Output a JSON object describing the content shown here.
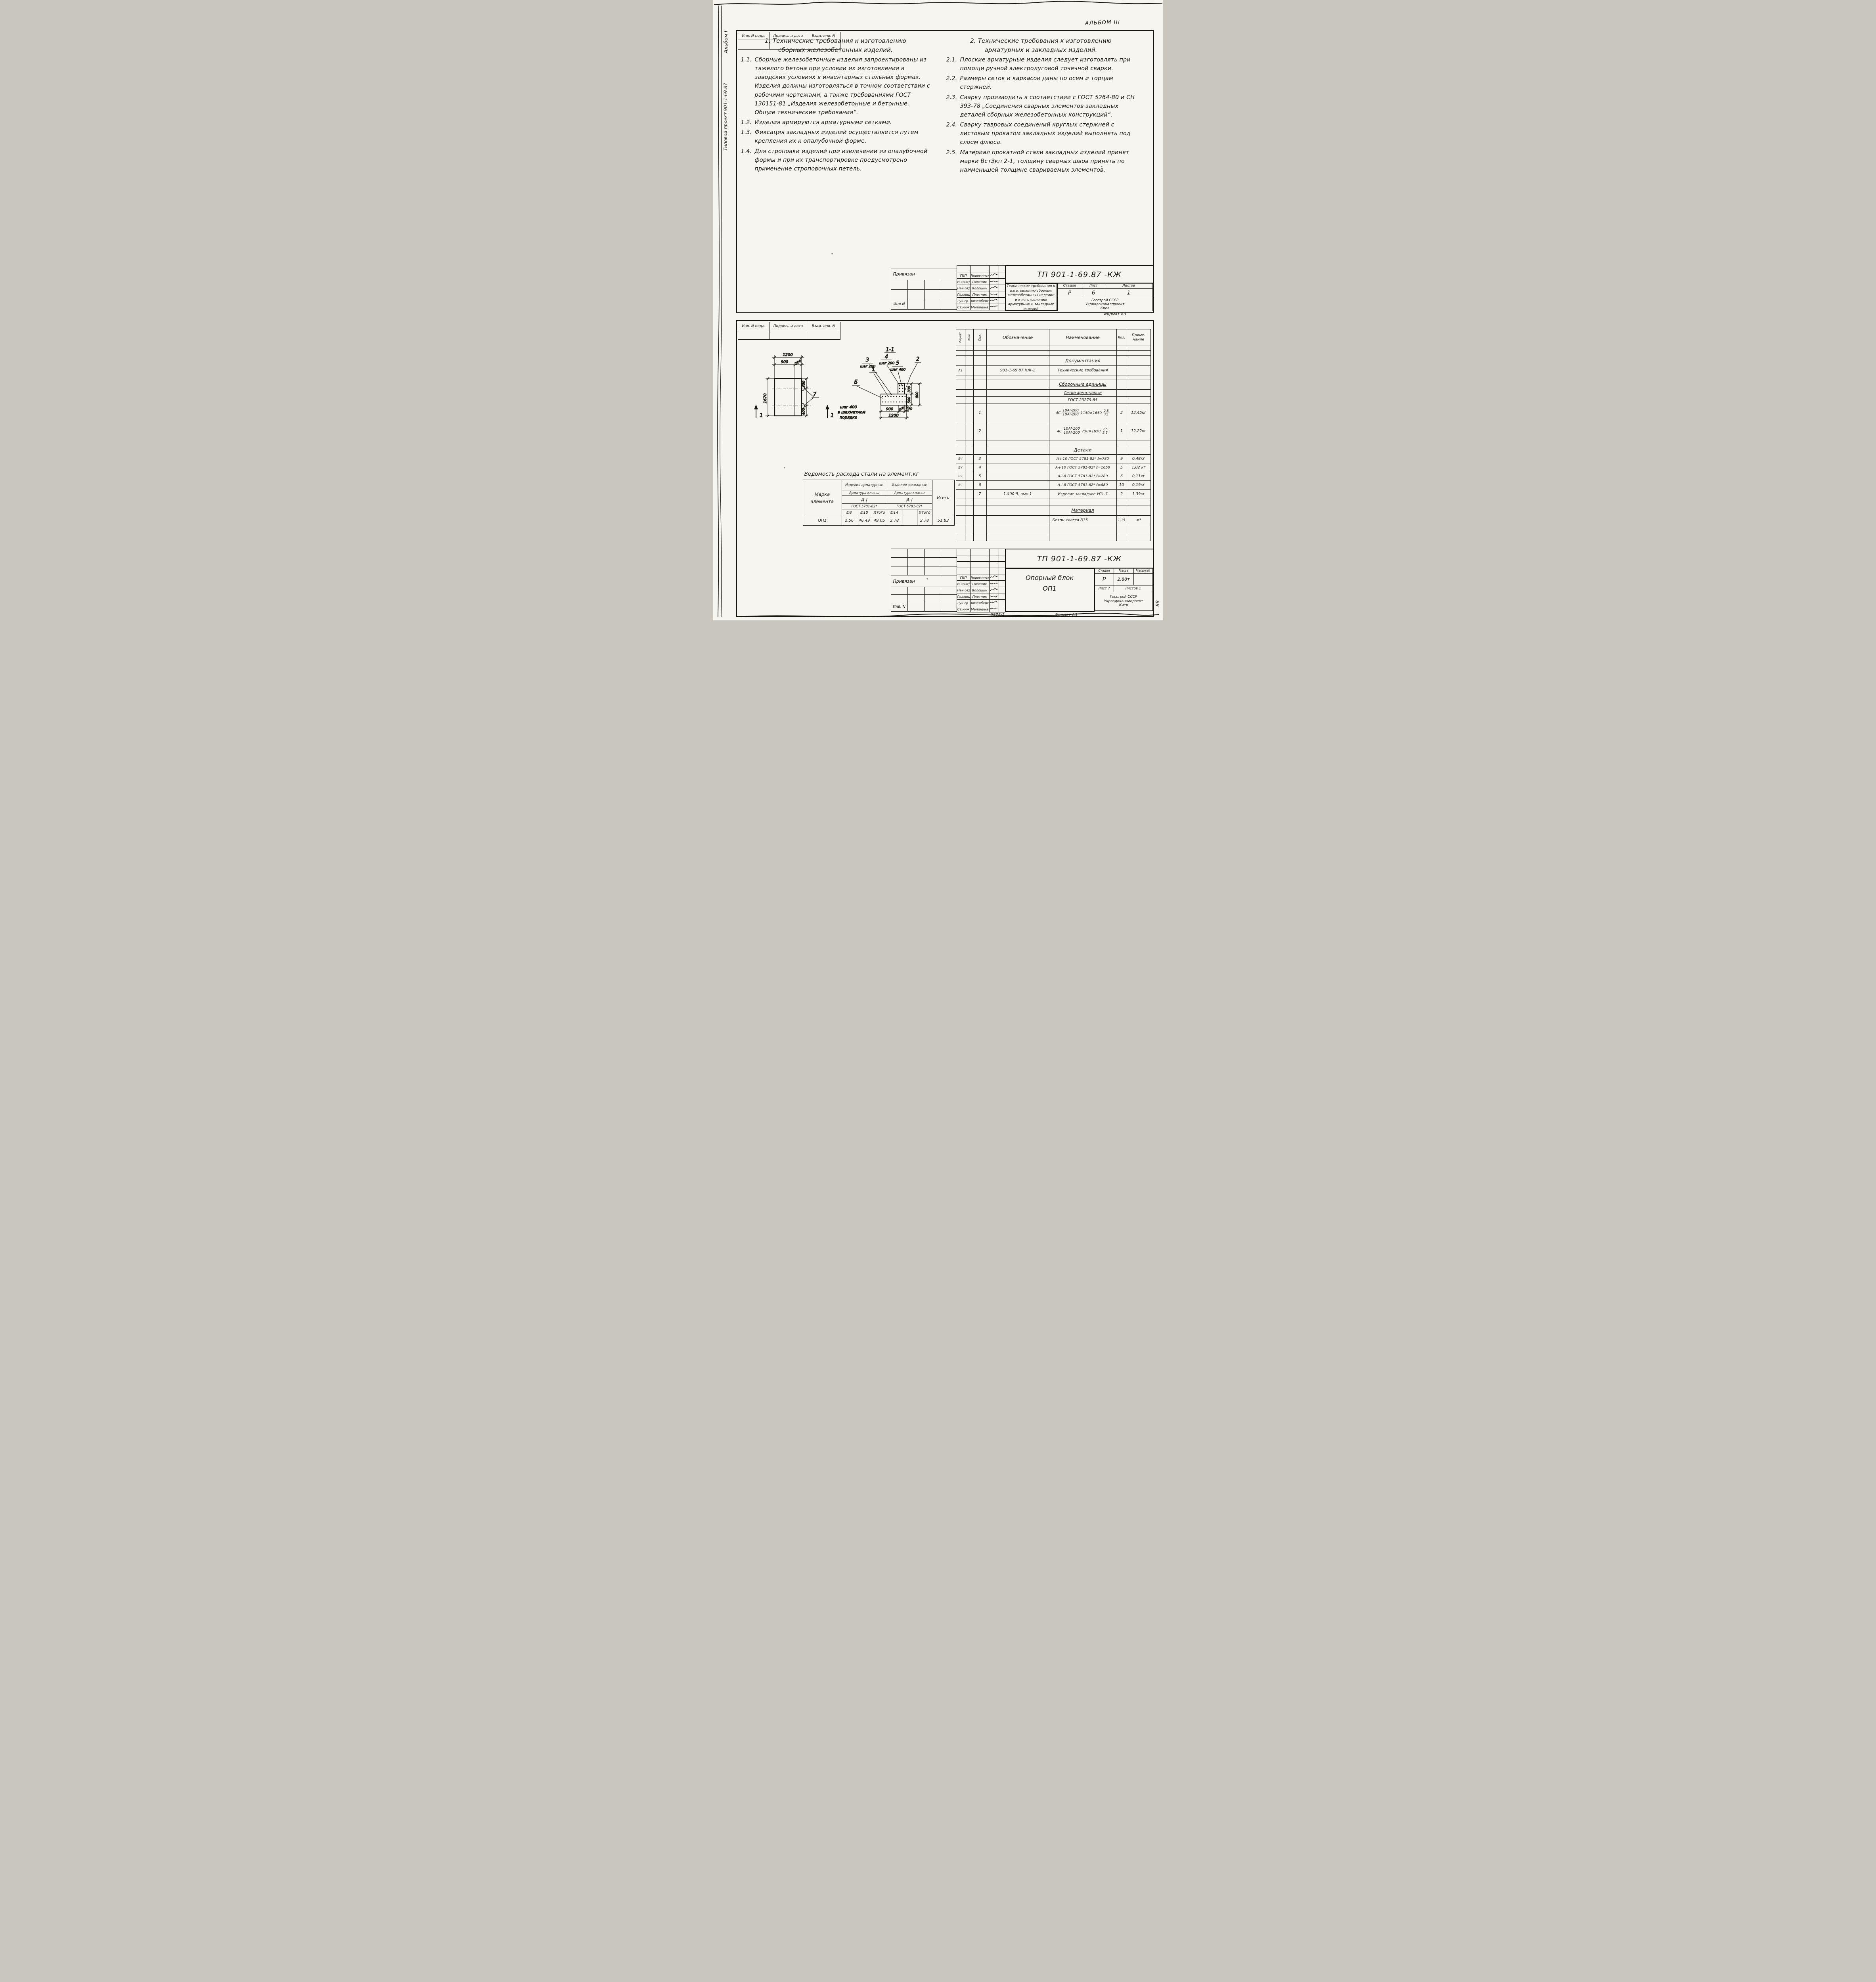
{
  "doc": {
    "album_note": "АЛЬБОМ III",
    "margin_album": "Альбом I",
    "margin_project": "Типовой проект 901-1-69.87",
    "margin_mark": "88",
    "stamp": {
      "c1": "Инв. N подл.",
      "c2": "Подпись и дата",
      "c3": "Взам. инв. N"
    }
  },
  "sheet1": {
    "sec1": {
      "title1": "1. Технические требования  к изготовлению",
      "title2": "сборных железобетонных изделий.",
      "items": [
        {
          "num": "1.1.",
          "text": "Сборные железобетонные изделия запроектированы из тяжелого бетона при условии их изготовления в заводских условиях в инвентарных стальных формах. Изделия должны изготовляться в точном соответствии с рабочими чертежами, а также требованиями ГОСТ 130151-81 „Изделия железобетонные и бетонные. Общие технические требования“."
        },
        {
          "num": "1.2.",
          "text": "Изделия армируются арматурными сетками."
        },
        {
          "num": "1.3.",
          "text": "Фиксация закладных изделий осуществляется путем крепления их к опалубочной форме."
        },
        {
          "num": "1.4.",
          "text": "Для строповки изделий при извлечении из опалубочной формы и при их транспортировке предусмотрено применение строповочных петель."
        }
      ]
    },
    "sec2": {
      "title1": "2. Технические требования к изготовлению",
      "title2": "арматурных и закладных изделий.",
      "items": [
        {
          "num": "2.1.",
          "text": "Плоские арматурные изделия следует изготовлять при помощи ручной электродуговой точечной сварки."
        },
        {
          "num": "2.2.",
          "text": "Размеры сеток и каркасов даны по осям и торцам стержней."
        },
        {
          "num": "2.3.",
          "text": "Сварку производить в соответствии с ГОСТ 5264-80 и СН 393-78 „Соединения сварных элементов закладных деталей сборных железобетонных конструкций“."
        },
        {
          "num": "2.4.",
          "text": "Сварку тавровых соединений круглых стержней с листовым прокатом закладных изделий выполнять под слоем флюса."
        },
        {
          "num": "2.5.",
          "text": "Материал прокатной стали закладных изделий принят марки ВстЗкп 2-1, толщину сварных швов принять по наименьшей толщине свариваемых элементов."
        }
      ]
    },
    "tb": {
      "attached": "Привязан",
      "inv": "Инв.N",
      "code": "ТП 901-1-69.87    -КЖ",
      "doc_title": "Технические требования к изготовлению сборных железобетонных изделий и к изготовлению арматурных и закладных изделий",
      "roles": [
        {
          "r": "ГИП",
          "n": "Новоминский"
        },
        {
          "r": "Н.контр.",
          "n": "Плотник"
        },
        {
          "r": "Нач.отд.",
          "n": "Волошин"
        },
        {
          "r": "Гл.спец.",
          "n": "Плотник"
        },
        {
          "r": "Рук.гр.",
          "n": "Айзенберг"
        },
        {
          "r": "Ст.инж.",
          "n": "Малинина"
        }
      ],
      "stage_h": "Стадия",
      "sheet_h": "Лист",
      "sheets_h": "Листов",
      "stage": "Р",
      "sheet": "6",
      "sheets": "1",
      "org1": "Госстрой СССР",
      "org2": "Укрводоканалпроект",
      "org3": "Киев",
      "format": "Формат А3"
    }
  },
  "sheet2": {
    "dwg": {
      "sec_title": "1-1",
      "plan_total": "1200",
      "plan_a": "900",
      "plan_b": "300",
      "plan_h": "1670",
      "plan_r1": "400",
      "plan_r2": "400",
      "loop_callout": "7",
      "cut1": "1",
      "cut2": "1",
      "c1": "1",
      "c2": "2",
      "c3": "3",
      "c3n": "шаг 200",
      "c4": "4",
      "c4n": "шаг 200",
      "c5": "5",
      "c5n": "шаг 400",
      "cb": "Б",
      "cbn1": "шаг 400",
      "cbn2": "в шахматном",
      "cbn3": "порядке",
      "db1": "900",
      "db2": "300",
      "db3": "70",
      "dbt": "1200",
      "dr1": "300",
      "dr2": "500",
      "dr3": "800",
      "dr4": "100"
    },
    "steel": {
      "title": "Ведомость расхода стали на элемент,кг",
      "mark1": "Марка",
      "mark2": "элемента",
      "g1": "Изделия арматурные",
      "g2": "Изделия закладные",
      "cls1": "Арматура класса",
      "cls2": "Арматура класса",
      "cl1": "А-I",
      "cl2": "А-I",
      "gost1": "ГОСТ 5781-82*",
      "gost2": "ГОСТ 5781-82*",
      "d1": "Ø8",
      "d2": "Ø10",
      "i1": "Итого",
      "d3": "Ø14",
      "d4": "",
      "i2": "Итого",
      "total_h": "Всего",
      "mark": "ОП1",
      "v1": "2,56",
      "v2": "46,49",
      "v3": "49,05",
      "v4": "2,78",
      "v5": "",
      "v6": "2,78",
      "vt": "51,83"
    },
    "spec": {
      "h_format": "Формат",
      "h_zone": "Зона",
      "h_pos": "Поз.",
      "h_desig": "Обозначение",
      "h_name": "Наименование",
      "h_qty": "Кол.",
      "h_note1": "Приме-",
      "h_note2": "чание",
      "sec_doc": "Документация",
      "doc": {
        "format": "А3",
        "desig": "901-1-69.87 КЖ-1",
        "name": "Технические требования"
      },
      "sec_asm": "Сборочные единицы",
      "asm1": "Сетки арматурные",
      "asm2": "ГОСТ 23279-85",
      "mesh1": {
        "pos": "1",
        "pre": "4С",
        "fn": "10АI-200",
        "fd": "10АI-200",
        "size": "1150×1650",
        "gn": "2,5",
        "gd": "75",
        "qty": "2",
        "note": "12,45кг"
      },
      "mesh2": {
        "pos": "2",
        "pre": "4С",
        "fn": "10АI-100",
        "fd": "10АI-200",
        "size": "750×1650",
        "gn": "2,5",
        "gd": "2,5",
        "qty": "1",
        "note": "12,22кг"
      },
      "sec_det": "Детали",
      "det": [
        {
          "format": "БЧ",
          "pos": "3",
          "desig": "",
          "name": "А-I-10 ГОСТ 5781-82* ℓ=780",
          "qty": "9",
          "note": "0,48кг"
        },
        {
          "format": "БЧ",
          "pos": "4",
          "desig": "",
          "name": "А-I-10 ГОСТ 5781-82* ℓ=1650",
          "qty": "5",
          "note": "1,02 кг"
        },
        {
          "format": "БЧ",
          "pos": "5",
          "desig": "",
          "name": "А-I-8 ГОСТ 5781-82* ℓ=280",
          "qty": "6",
          "note": "0,11кг"
        },
        {
          "format": "БЧ",
          "pos": "6",
          "desig": "",
          "name": "А-I-8 ГОСТ 5781-82* ℓ=480",
          "qty": "10",
          "note": "0,19кг"
        },
        {
          "format": "",
          "pos": "7",
          "desig": "1.400-9, вып.1",
          "name": "Изделие закладное УП1-7",
          "qty": "2",
          "note": "1,39кг"
        }
      ],
      "sec_mat": "Материал",
      "mat": {
        "name": "Бетон класса В15",
        "qty": "1,15",
        "note": "м³"
      }
    },
    "tb": {
      "attached": "Привязан",
      "inv": "Инв. N",
      "code": "ТП 901-1-69.87   -КЖ",
      "name1": "Опорный блок",
      "name2": "ОП1",
      "roles": [
        {
          "r": "ГИП",
          "n": "Новоминский"
        },
        {
          "r": "Н.контр.",
          "n": "Плотник"
        },
        {
          "r": "Нач.отд.",
          "n": "Волошин"
        },
        {
          "r": "Гл.спец.",
          "n": "Плотник"
        },
        {
          "r": "Рук.гр.",
          "n": "Айзенберг"
        },
        {
          "r": "Ст.инж.",
          "n": "Малинина"
        }
      ],
      "stage_h": "Стадия",
      "mass_h": "Масса",
      "scale_h": "Масштаб",
      "stage": "Р",
      "mass": "2,88т",
      "scale": "",
      "sheet_info": "Лист 7",
      "sheets_info": "Листов 1",
      "org1": "Госстрой СССР",
      "org2": "Укрводоканалпроект",
      "org3": "Киев",
      "doc_num": "9575/1",
      "format": "Формат А3"
    }
  }
}
